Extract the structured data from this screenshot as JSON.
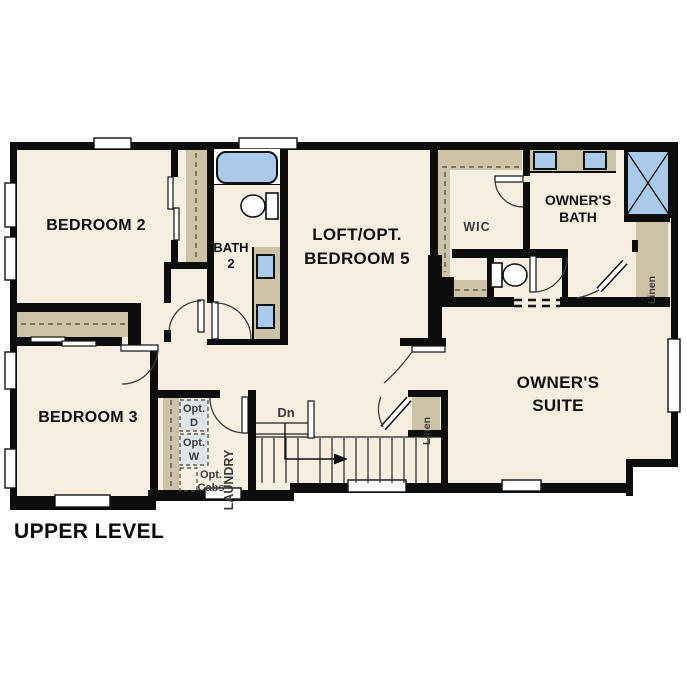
{
  "title": "UPPER LEVEL",
  "rooms": {
    "bedroom2": "BEDROOM 2",
    "bedroom3": "BEDROOM 3",
    "bath2": [
      "BATH",
      "2"
    ],
    "loft": [
      "LOFT/OPT.",
      "BEDROOM 5"
    ],
    "wic": "WIC",
    "owners_bath": [
      "OWNER'S",
      "BATH"
    ],
    "owners_suite": [
      "OWNER'S",
      "SUITE"
    ],
    "laundry": "LAUNDRY"
  },
  "fixtures": {
    "linen_bath": "Linen",
    "linen_hall": "Linen",
    "opt_dryer": [
      "Opt.",
      "D"
    ],
    "opt_washer": [
      "Opt.",
      "W"
    ],
    "opt_cabs": [
      "Opt.",
      "Cabs"
    ],
    "stairs_down": "Dn"
  },
  "colors": {
    "background": "#ffffff",
    "floor": "#f5eee1",
    "wall": "#0d0d0d",
    "casework": "#cdc1a6",
    "fixture_blue": "#a9cbe9",
    "appliance_gray": "#dfe4e8"
  }
}
